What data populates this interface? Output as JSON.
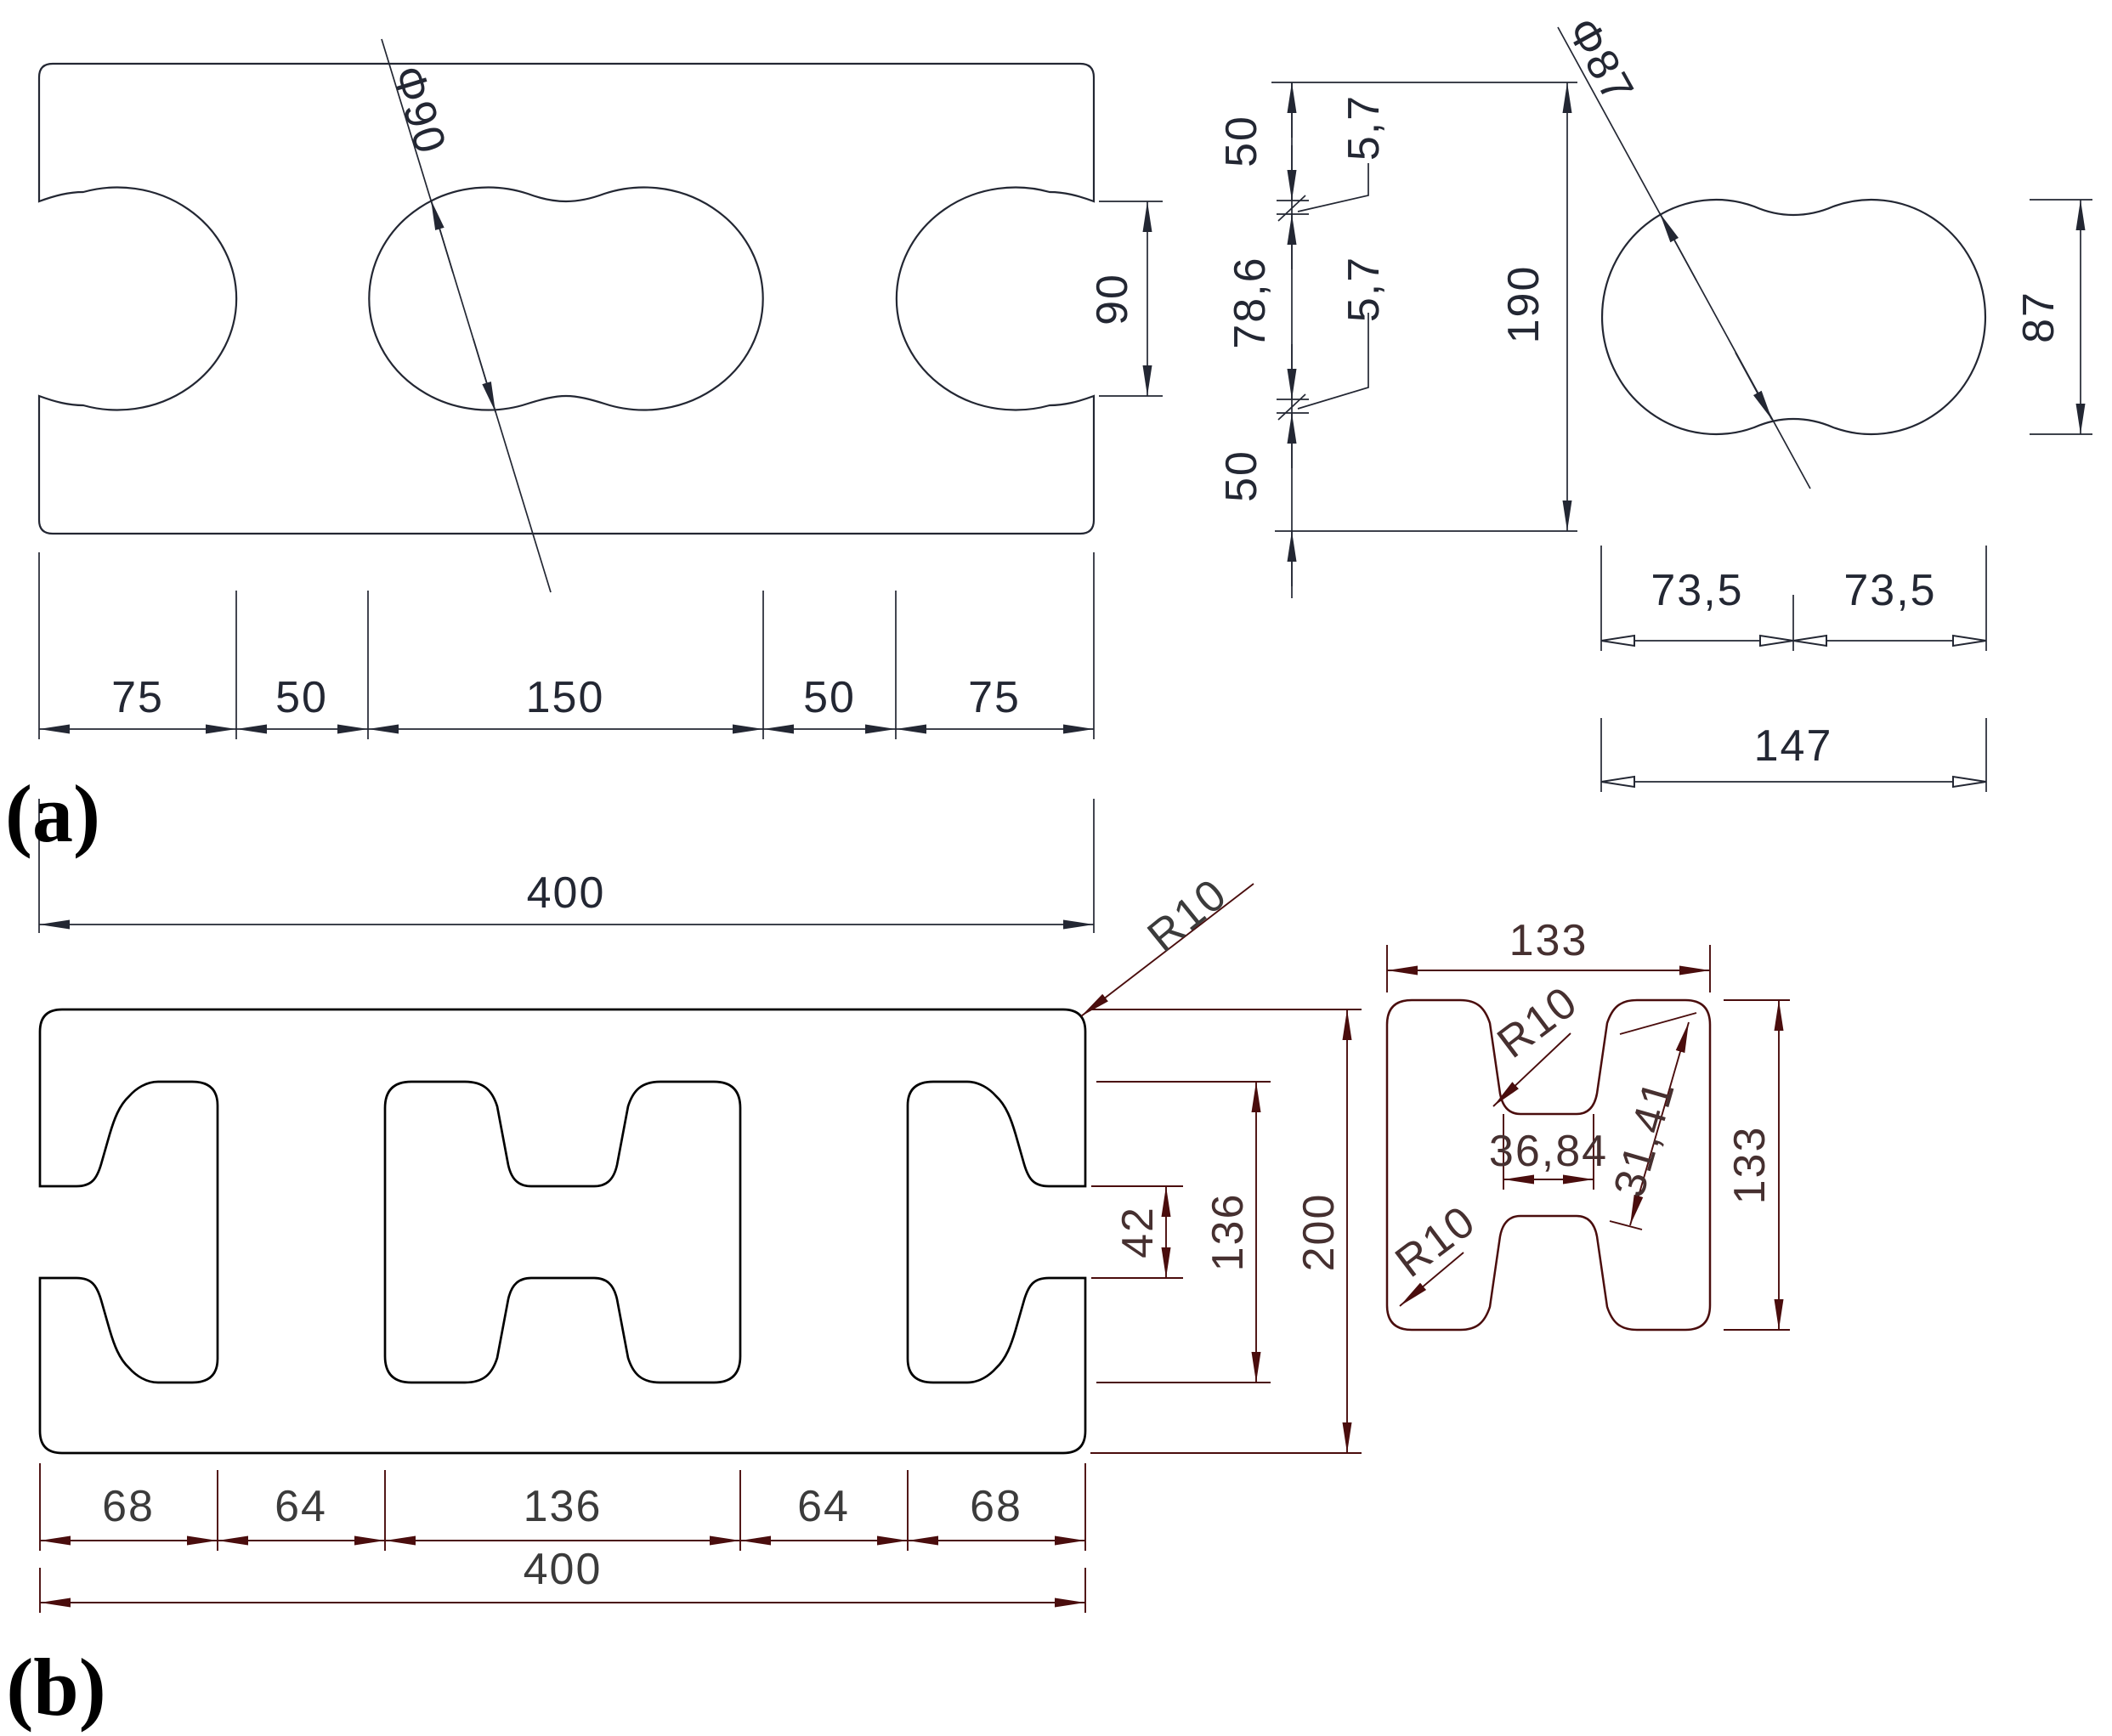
{
  "colors": {
    "ink_a": "#232733",
    "geo_b": "#000000",
    "dim_b": "#4a0d0d",
    "text_b": "#3b3b3b",
    "text_b_detail": "#463030",
    "paper": "#ffffff"
  },
  "panel_a": {
    "label": "(a)",
    "main": {
      "phi": "Φ90",
      "side": "90",
      "chain": [
        "75",
        "50",
        "150",
        "50",
        "75"
      ],
      "total": "400"
    },
    "heights": {
      "chain": [
        "50",
        "5,7",
        "78,6",
        "5,7",
        "50"
      ],
      "total": "190"
    },
    "detail": {
      "phi": "Φ87",
      "side": "87",
      "half_left": "73,5",
      "half_right": "73,5",
      "total": "147"
    }
  },
  "panel_b": {
    "label": "(b)",
    "main": {
      "corner_radius": "R10",
      "chain": [
        "68",
        "64",
        "136",
        "64",
        "68"
      ],
      "total": "400",
      "web": "42",
      "cutout": "136",
      "height": "200"
    },
    "detail": {
      "width": "133",
      "height": "133",
      "fillet_top": "R10",
      "fillet_bottom": "R10",
      "neck": "36,84",
      "slant": "31,41"
    }
  }
}
